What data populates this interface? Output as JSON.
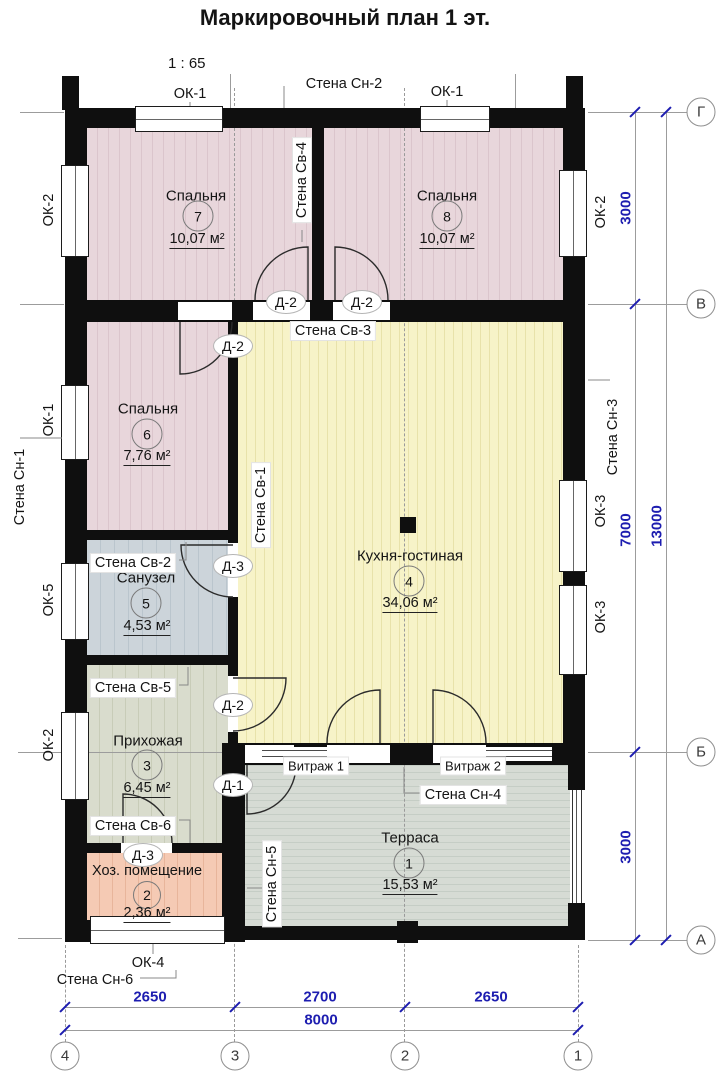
{
  "title": "Маркировочный план 1 эт.",
  "scale": "1 : 65",
  "rooms": {
    "terrace": {
      "name": "Терраса",
      "num": "1",
      "area": "15,53 м²"
    },
    "utility": {
      "name": "Хоз. помещение",
      "num": "2",
      "area": "2,36 м²"
    },
    "hall": {
      "name": "Прихожая",
      "num": "3",
      "area": "6,45 м²"
    },
    "kitchen": {
      "name": "Кухня-гостиная",
      "num": "4",
      "area": "34,06 м²"
    },
    "bath": {
      "name": "Санузел",
      "num": "5",
      "area": "4,53 м²"
    },
    "bed6": {
      "name": "Спальня",
      "num": "6",
      "area": "7,76 м²"
    },
    "bed7": {
      "name": "Спальня",
      "num": "7",
      "area": "10,07 м²"
    },
    "bed8": {
      "name": "Спальня",
      "num": "8",
      "area": "10,07 м²"
    }
  },
  "wall_labels": {
    "sn1": "Стена Сн-1",
    "sn2": "Стена Сн-2",
    "sn3": "Стена Сн-3",
    "sn4": "Стена Сн-4",
    "sn5": "Стена Сн-5",
    "sn6": "Стена Сн-6",
    "sv1": "Стена Св-1",
    "sv2": "Стена Св-2",
    "sv3": "Стена Св-3",
    "sv4": "Стена Св-4",
    "sv5": "Стена Св-5",
    "sv6": "Стена Св-6"
  },
  "window_labels": {
    "ok1": "ОК-1",
    "ok2": "ОК-2",
    "ok3": "ОК-3",
    "ok4": "ОК-4",
    "ok5": "ОК-5"
  },
  "vitrage_labels": {
    "v1": "Витраж 1",
    "v2": "Витраж 2"
  },
  "door_labels": {
    "d1": "Д-1",
    "d2": "Д-2",
    "d3": "Д-3"
  },
  "axes": {
    "right": [
      "Г",
      "В",
      "Б",
      "А"
    ],
    "bottom": [
      "4",
      "3",
      "2",
      "1"
    ]
  },
  "dimensions": {
    "right": [
      "3000",
      "7000",
      "3000"
    ],
    "right_total": "13000",
    "bottom": [
      "2650",
      "2700",
      "2650"
    ],
    "bottom_total": "8000"
  },
  "colors": {
    "wall": "#0f0f0f",
    "dimension": "#1d1db0",
    "bedroom_fill": "#e8d6db",
    "kitchen_fill": "#f7f3c8",
    "bath_fill": "#ccd4da",
    "hall_fill": "#d9dccd",
    "utility_fill": "#f5cab4",
    "terrace_fill": "#d6dbd4"
  }
}
